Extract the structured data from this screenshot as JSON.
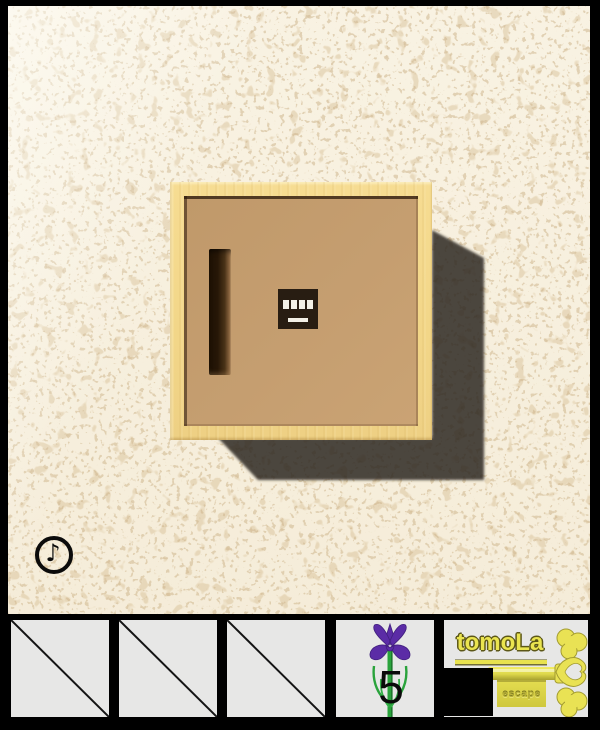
{
  "scene": {
    "wall": {
      "base_color": "#f8f1e0",
      "speckle_color": "#cdb289"
    },
    "box": {
      "frame_color": "#f2d688",
      "panel_color": "#c59e70",
      "groove": "vertical-slot",
      "keypad_cells": 4
    },
    "music_button": {
      "glyph": "♪"
    },
    "shadow_color": "rgba(40,37,32,0.84)"
  },
  "inventory": {
    "slots": [
      {
        "id": "slot-1",
        "state": "empty"
      },
      {
        "id": "slot-2",
        "state": "empty"
      },
      {
        "id": "slot-3",
        "state": "empty"
      },
      {
        "id": "slot-4",
        "state": "item",
        "item": "iris-flower",
        "count_label": "5"
      },
      {
        "id": "slot-5",
        "state": "logo",
        "brand": "tomoLa",
        "brand_sub": "escape"
      }
    ]
  }
}
